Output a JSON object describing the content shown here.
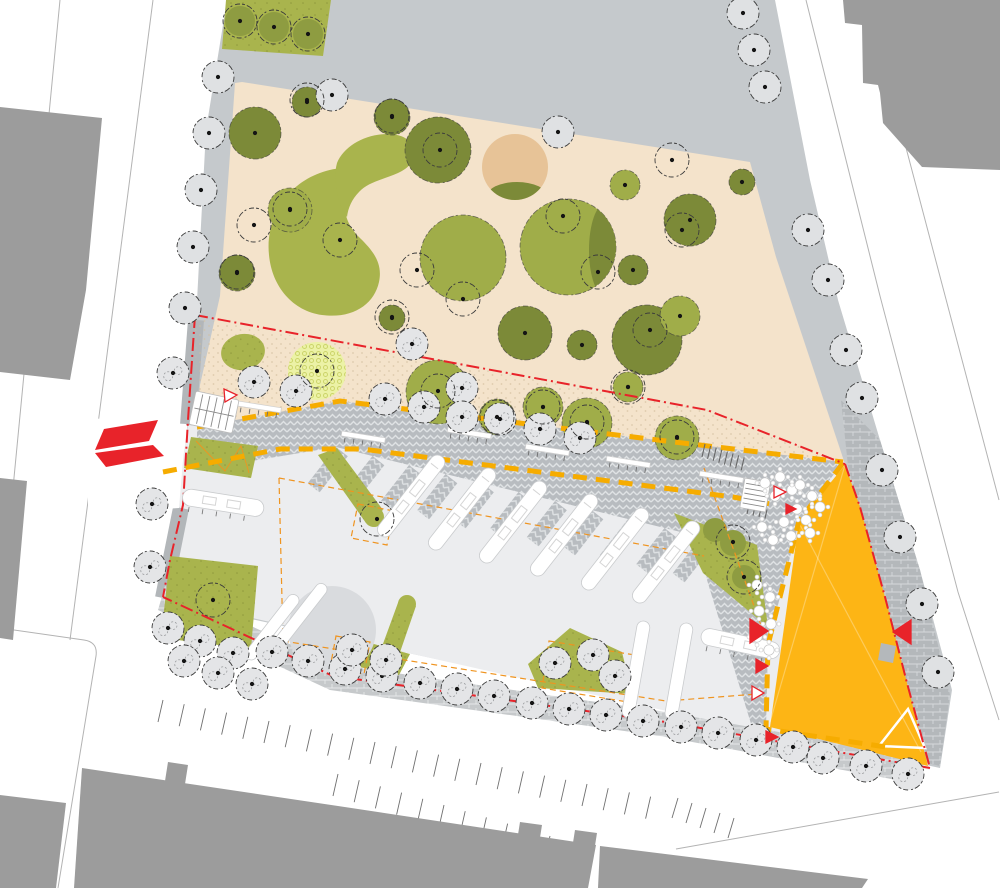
{
  "plan": {
    "kind": "landscape-architecture-site-plan",
    "canvas": {
      "w": 1000,
      "h": 888
    },
    "palette": {
      "white": "#ffffff",
      "street_line": "#b3b3b3",
      "building": "#9c9c9c",
      "base_gray": "#c5c9cc",
      "plaza_light": "#ecedef",
      "sliver_gray": "#b2b6b9",
      "beige": "#f4e3cb",
      "tan": "#e7c397",
      "lawn": "#a9b44d",
      "canopy_dark": "#7c8a38",
      "canopy_mid": "#8e9c41",
      "canopy_light": "#a0ad49",
      "playground_fill": "#ecf2a6",
      "playground_ring": "#ccd46a",
      "hatch_bg": "#b8bcc0",
      "hatch_line": "#dfe2e4",
      "brick_bg_south": "#c6c9cb",
      "brick_bg_right": "#b4b8bb",
      "brick_line": "#e6e8e9",
      "amber": "#fdb515",
      "red": "#e8232a",
      "yellow_dash": "#f6ac00",
      "orange_dash": "#ef9420",
      "tree_fill_plain": "#dfe1e3",
      "tree_fill_detail": "#e4e5e7",
      "tree_stroke": "#3c3c3c",
      "dot": "#141414",
      "bench_stroke": "#c9cbcd",
      "circle_plaza": "#d9dbde"
    },
    "streets": {
      "lines": [
        "M60,0 L3,592",
        "M153,0 L70,640",
        "M806,0 L880,296 L958,592 L999,720",
        "M867,0 L999,500",
        "M676,849 L999,792",
        "M0,628 L84,640 Q98,642 96,656 L58,888"
      ],
      "parking_rows": [
        {
          "x": 158,
          "y": 722,
          "stepx": 21.2,
          "stepy": 4.2,
          "n": 24,
          "tx": 5,
          "ty": -22
        },
        {
          "x": 333,
          "y": 796,
          "stepx": 21.2,
          "stepy": 6.2,
          "n": 15,
          "tx": 5,
          "ty": -22
        },
        {
          "x": 672,
          "y": 818,
          "stepx": 14.0,
          "stepy": 5.0,
          "n": 5,
          "tx": 6,
          "ty": -20
        }
      ]
    },
    "buildings": [
      "0,107 102,118 86,290 70,380 0,372",
      "0,478 27,481 13,640 0,638",
      "0,795 66,803 56,888 0,888",
      "82,768 338,806 596,845 588,888 74,888",
      "168,762 188,765 185,784 165,781",
      "520,822 542,825 539,844 517,841",
      "575,830 597,833 594,852 572,849",
      "600,846 868,879 862,888 598,888",
      "338,0 362,0 360,14 336,12",
      "378,0 548,0 546,24 460,27 456,13 376,15",
      "560,0 745,0 738,116 690,122 668,30 560,22",
      "843,0 1000,0 1000,170 922,167 883,123 880,93 878,85 863,83 862,25 845,23"
    ],
    "site": {
      "base": "227,0 775,0 810,180 838,300 880,440 920,570 952,690 940,768 163,600 170,560 181,505 187,428 196,320 206,130",
      "beige": "242,82 750,162 776,257 845,464 666,442 340,402 197,428 200,385 220,296 235,83",
      "plaza": "188,424 845,462 930,770 163,598",
      "stipple_zone": "195,318 707,410 845,464 666,442 340,402 197,428",
      "sliver_paths": [
        "M196,320 L188,425",
        "M181,508 L163,598"
      ],
      "entrance_notch": "88,418 186,424 179,508 88,514",
      "lawn_rect_top": "226,0 331,0 323,56 222,49"
    },
    "esplanade": {
      "band": "197,427 340,401 666,441 843,462 799,521 768,645 766,729 752,727 707,580 701,537 336,447 197,470",
      "teeth": {
        "x": 336,
        "y": 447,
        "stepx": 36.5,
        "stepy": 9.0,
        "n": 11,
        "w": 15,
        "len": 46,
        "rot": 38
      },
      "bars_big": {
        "pts": [
          [
            436,
            452
          ],
          [
            487,
            465
          ],
          [
            538,
            478
          ],
          [
            589,
            491
          ],
          [
            640,
            505
          ],
          [
            691,
            518
          ]
        ],
        "w": 15,
        "len": 100,
        "rot": 38
      },
      "bars_small": {
        "pts": [
          [
            292,
            592
          ],
          [
            320,
            581
          ]
        ],
        "w": 12,
        "len": 80,
        "rot": 38
      },
      "stripes": {
        "pts": [
          [
            638,
            620
          ],
          [
            681,
            622
          ]
        ],
        "w": 13,
        "len": 98,
        "rot": 10
      },
      "benches_small": [
        [
          238,
          401
        ],
        [
          342,
          431
        ],
        [
          448,
          427
        ],
        [
          526,
          444
        ],
        [
          607,
          456
        ],
        [
          700,
          471
        ]
      ],
      "benches_long": [
        {
          "x": 184,
          "y": 488,
          "rot": 9,
          "len": 82,
          "w": 17
        },
        {
          "x": 703,
          "y": 627,
          "rot": 12,
          "len": 80,
          "w": 17
        }
      ],
      "bike_racks": {
        "x": 702,
        "y": 457,
        "stepx": 5.6,
        "stepy": 1.9,
        "n": 8,
        "tx": 3,
        "ty": -13
      },
      "kiosk_ticks": {
        "x": 747,
        "y": 514,
        "stepx": 6,
        "stepy": 1.5,
        "n": 4,
        "tx": 2,
        "ty": -9
      }
    },
    "paving": {
      "south_strip": "165,586 333,664 666,712 925,758 918,784 660,736 330,690 158,610",
      "right_strip": "841,400 880,440 920,570 950,695 940,766 916,760 884,600 848,466"
    },
    "amber_plaza": {
      "poly": "845,465 860,507 885,597 907,683 928,766 770,727 799,521",
      "white_triangle": "908,709 925,748 879,746",
      "notch": "881,643 896,646 893,663 878,660",
      "creases": [
        "M845,465 L770,722",
        "M799,523 L921,752"
      ]
    },
    "lawns": {
      "polys": [
        "191,437 258,446 251,478 184,468",
        "170,556 258,566 251,649 161,638",
        "318,455 337,448 383,510 366,523",
        "399,600 416,606 398,658 380,652",
        "338,634 410,654 399,675 334,662",
        "570,628 622,652 632,694 538,688 528,664",
        "674,513 757,545 768,627 703,573"
      ],
      "tips": [
        [
          374,
          517,
          10
        ],
        [
          407,
          604,
          9
        ]
      ],
      "ellipse": {
        "cx": 243,
        "cy": 352,
        "rx": 22,
        "ry": 18,
        "rot": -10
      },
      "zigzag": "M196,441 L225,471 L241,446 L249,473"
    },
    "park": {
      "bean_big": "M297,186 C278,200 266,228 269,255 C272,287 293,311 322,315 C352,319 374,305 379,282 C383,263 373,251 361,239 C348,227 342,212 346,197 C349,185 355,176 362,170 C340,164 314,172 297,186 Z",
      "bean_small": "M337,163 C344,146 365,134 388,134 C402,134 412,140 414,150 C416,160 409,168 398,173 C382,180 368,182 359,192 C352,199 348,208 347,217 C339,206 332,181 337,163 Z",
      "canopies": [
        [
          255,
          133,
          26,
          "d"
        ],
        [
          307,
          102,
          15,
          "d"
        ],
        [
          392,
          117,
          18,
          "d"
        ],
        [
          438,
          150,
          33,
          "d"
        ],
        [
          568,
          247,
          48,
          "l"
        ],
        [
          625,
          185,
          15,
          "l"
        ],
        [
          290,
          210,
          22,
          "l"
        ],
        [
          237,
          273,
          18,
          "d"
        ],
        [
          463,
          258,
          43,
          "l"
        ],
        [
          525,
          333,
          27,
          "d"
        ],
        [
          647,
          340,
          35,
          "d"
        ],
        [
          582,
          345,
          15,
          "d"
        ],
        [
          392,
          318,
          13,
          "d"
        ],
        [
          438,
          392,
          32,
          "l"
        ],
        [
          497,
          417,
          18,
          "l"
        ],
        [
          543,
          407,
          20,
          "l"
        ],
        [
          587,
          423,
          25,
          "l"
        ],
        [
          677,
          438,
          22,
          "l"
        ],
        [
          628,
          387,
          15,
          "l"
        ],
        [
          633,
          270,
          15,
          "d"
        ],
        [
          690,
          220,
          26,
          "d"
        ],
        [
          742,
          182,
          13,
          "d"
        ],
        [
          680,
          316,
          20,
          "l"
        ]
      ],
      "small_canopies": [
        [
          715,
          530,
          12
        ],
        [
          733,
          543,
          13
        ],
        [
          744,
          577,
          12
        ],
        [
          240,
          21,
          15
        ],
        [
          274,
          27,
          15
        ],
        [
          308,
          34,
          15
        ]
      ],
      "tan_circle": [
        515,
        167,
        33
      ],
      "tan_crescent": {
        "cx": 517,
        "cy": 196,
        "rx": 30,
        "ry": 14
      },
      "big_crescent": {
        "cx": 605,
        "cy": 250,
        "rx": 16,
        "ry": 46
      },
      "playground": {
        "cx": 317,
        "cy": 371,
        "r": 29
      }
    },
    "furniture": {
      "circle_plaza": [
        332,
        630,
        44
      ],
      "kiosk_solar": {
        "x": 196,
        "y": 391,
        "rot": 12,
        "w": 44,
        "h": 34
      },
      "kiosk_cafe": {
        "x": 745,
        "y": 478,
        "rot": 10,
        "w": 26,
        "h": 30
      },
      "tables": [
        [
          765,
          483
        ],
        [
          780,
          477
        ],
        [
          792,
          490
        ],
        [
          775,
          496
        ],
        [
          800,
          485
        ],
        [
          812,
          496
        ],
        [
          820,
          507
        ],
        [
          797,
          509
        ],
        [
          806,
          520
        ],
        [
          784,
          522
        ],
        [
          791,
          536
        ],
        [
          773,
          540
        ],
        [
          762,
          527
        ],
        [
          810,
          533
        ],
        [
          757,
          585
        ],
        [
          770,
          597
        ],
        [
          759,
          611
        ],
        [
          771,
          624
        ],
        [
          757,
          637
        ],
        [
          769,
          650
        ]
      ]
    },
    "trees": {
      "plain": [
        [
          218,
          77
        ],
        [
          209,
          133
        ],
        [
          201,
          190
        ],
        [
          193,
          247
        ],
        [
          185,
          308
        ],
        [
          743,
          13
        ],
        [
          754,
          50
        ],
        [
          765,
          87
        ],
        [
          808,
          230
        ],
        [
          828,
          280
        ],
        [
          846,
          350
        ],
        [
          862,
          398
        ],
        [
          882,
          470
        ],
        [
          900,
          537
        ],
        [
          922,
          604
        ],
        [
          938,
          672
        ],
        [
          558,
          132
        ],
        [
          332,
          95
        ]
      ],
      "detail": [
        [
          173,
          373
        ],
        [
          152,
          504
        ],
        [
          150,
          567
        ],
        [
          168,
          628
        ],
        [
          200,
          641
        ],
        [
          233,
          653
        ],
        [
          184,
          661
        ],
        [
          218,
          673
        ],
        [
          252,
          684
        ],
        [
          272,
          652
        ],
        [
          308,
          661
        ],
        [
          345,
          669
        ],
        [
          382,
          676
        ],
        [
          420,
          683
        ],
        [
          457,
          689
        ],
        [
          494,
          696
        ],
        [
          532,
          703
        ],
        [
          569,
          709
        ],
        [
          606,
          715
        ],
        [
          643,
          721
        ],
        [
          681,
          727
        ],
        [
          718,
          733
        ],
        [
          756,
          740
        ],
        [
          793,
          747
        ],
        [
          823,
          758
        ],
        [
          866,
          766
        ],
        [
          908,
          774
        ],
        [
          254,
          382
        ],
        [
          296,
          391
        ],
        [
          385,
          399
        ],
        [
          412,
          344
        ],
        [
          424,
          407
        ],
        [
          462,
          388
        ],
        [
          462,
          417
        ],
        [
          500,
          419
        ],
        [
          540,
          429
        ],
        [
          580,
          438
        ],
        [
          352,
          650
        ],
        [
          386,
          660
        ],
        [
          555,
          663
        ],
        [
          593,
          655
        ],
        [
          615,
          676
        ]
      ],
      "sketch": [
        [
          307,
          100
        ],
        [
          392,
          116
        ],
        [
          440,
          150
        ],
        [
          290,
          209
        ],
        [
          463,
          299
        ],
        [
          563,
          216
        ],
        [
          598,
          272
        ],
        [
          650,
          330
        ],
        [
          417,
          270
        ],
        [
          340,
          240
        ],
        [
          254,
          225
        ],
        [
          237,
          272
        ],
        [
          317,
          371
        ],
        [
          392,
          317
        ],
        [
          438,
          391
        ],
        [
          587,
          422
        ],
        [
          677,
          437
        ],
        [
          543,
          407
        ],
        [
          497,
          417
        ],
        [
          628,
          387
        ],
        [
          682,
          230
        ],
        [
          672,
          160
        ],
        [
          213,
          600
        ],
        [
          377,
          519
        ],
        [
          733,
          542
        ],
        [
          744,
          577
        ],
        [
          240,
          21
        ],
        [
          274,
          27
        ],
        [
          308,
          34
        ]
      ]
    },
    "overlays": {
      "red_boundary": [
        "M195,315 L707,410 L845,464",
        "M845,464 L860,507 L885,597 L907,683 L930,768",
        "M930,768 L666,722 L333,676 L163,597",
        "M195,315 L188,420 L183,505 L170,560 L163,597"
      ],
      "yellow_dashes": [
        "M197,427 L340,401 L666,441 L843,462",
        "M163,472 L280,449 L362,449 L733,497 L776,505",
        "M843,463 L799,521 L768,645 L766,729 L886,747"
      ],
      "orange_dashes": [
        "M279,478 L283,641",
        "M279,478 L704,556",
        "M283,641 L666,701 L757,694",
        "M549,641 L641,656 L634,703 L542,688 Z",
        "M358,504 l36,7 l-7,34 l-36,-7 Z",
        "M336,636 l34,6 l-6,32 l-34,-6 Z",
        "M704,468 L762,628"
      ],
      "red_markers": [
        {
          "pts": "750,619 768,631 750,643",
          "filled": true
        },
        {
          "pts": "911,620 893,632 911,644",
          "filled": true
        },
        {
          "pts": "756,659 768,666 756,673",
          "filled": true
        },
        {
          "pts": "752,686 764,693 752,700",
          "filled": false
        },
        {
          "pts": "774,486 786,492 774,498",
          "filled": false
        },
        {
          "pts": "786,504 796,509 786,514",
          "filled": true
        },
        {
          "pts": "766,731 778,737 766,743",
          "filled": true
        },
        {
          "pts": "224,389 237,395 225,402",
          "filled": false
        }
      ],
      "entrance_arrow": [
        "104,429 158,420 149,441 95,450",
        "95,453 153,445 164,456 106,467"
      ]
    }
  }
}
